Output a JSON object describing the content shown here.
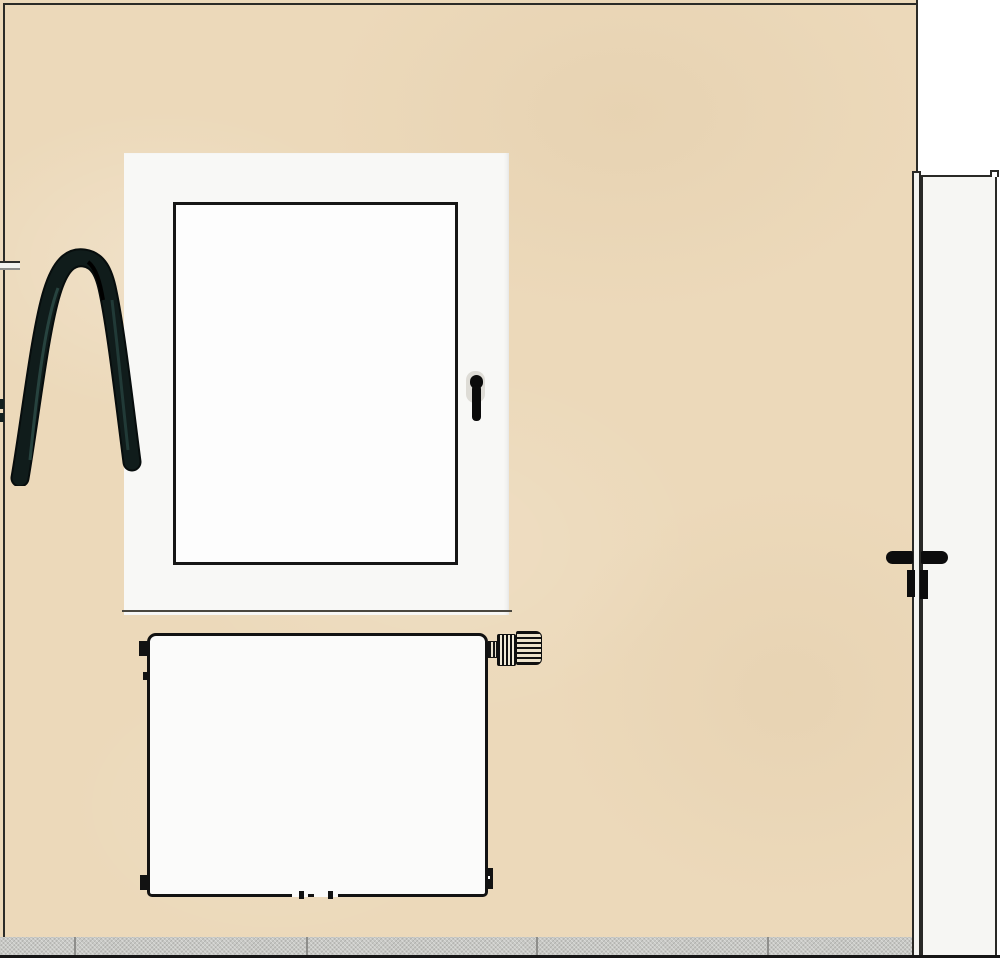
{
  "scene": {
    "background_color": "#ffffff",
    "wall": {
      "name": "wall",
      "color": "#ecd9ba",
      "outline_color": "#2b2b27"
    },
    "floor": {
      "name": "tiled-floor",
      "tile_color": "#c7c8c4",
      "grout_color": "#8e8e8b",
      "grout_positions_px": [
        74,
        306,
        536,
        767
      ],
      "baseline_color": "#161616"
    },
    "window": {
      "name": "casement-window",
      "frame_color": "#f8f8f6",
      "glass_color": "#fdfdfd",
      "sash_outline_color": "#161616",
      "sill_line_color": "#4a473f",
      "handle_color": "#0b0b0b",
      "handle_plate_color": "#dedcd6"
    },
    "radiator": {
      "name": "panel-radiator",
      "body_color": "#fbfbfa",
      "outline_color": "#121212",
      "valve": {
        "name": "thermostatic-valve",
        "stripe_color": "#101010",
        "base_color": "#ece2cb"
      }
    },
    "towel": {
      "name": "hanging-towel",
      "color": "#101c1b",
      "highlight_color": "#2c4a45",
      "rail_color": "#f3f3ef"
    },
    "door": {
      "name": "door",
      "slab_color": "#f6f6f3",
      "frame_color": "#f4f4f1",
      "outline_color": "#292926",
      "handle_color": "#0c0c0c"
    }
  }
}
